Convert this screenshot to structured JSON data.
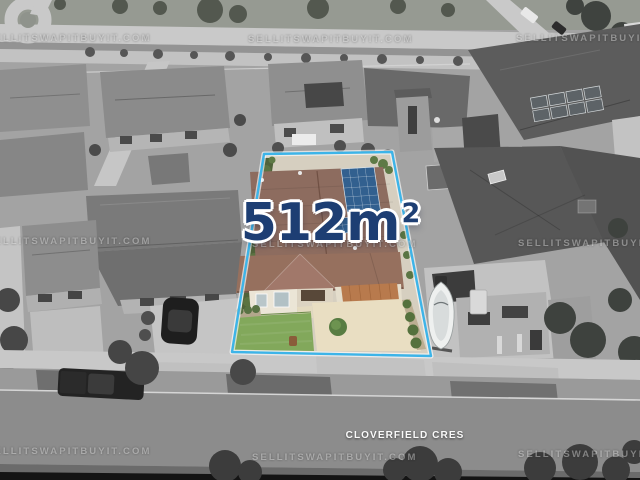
{
  "overlays": {
    "watermark": "SELLITSWAPITBUYIT.COM",
    "area": {
      "value": "512m",
      "superscript": "2"
    },
    "street": "CLOVERFIELD CRES"
  },
  "colors": {
    "boundary_line": "#3db4e8",
    "area_text": "#1d3e73",
    "street_text": "#fafafa",
    "watermark_text": "rgba(255,255,255,0.38)",
    "roof_main": "#8d6c5f",
    "roof_front": "#96705e",
    "gable": "#a1786a",
    "solar_panel": "#32608f",
    "lawn": "#82a85b",
    "driveway": "#e9dec2",
    "garage_door": "#b87a4d",
    "hedge": "#50633a"
  }
}
